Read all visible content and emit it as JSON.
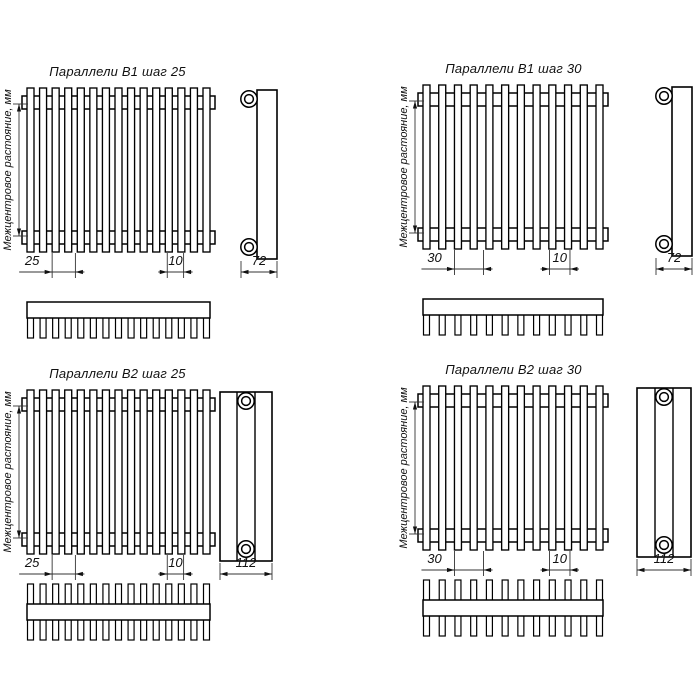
{
  "page": {
    "background": "#ffffff",
    "line_color": "#000000",
    "sheet_type": "technical drawing, radiator parallels"
  },
  "panels": [
    {
      "title": "Параллели В1 шаг 25",
      "variant": "В1",
      "step": "25",
      "tube_width": "10",
      "depth": "72",
      "tube_count": 15,
      "tube_rows": 1,
      "center_distance_label": "Межцентровое растояние, мм"
    },
    {
      "title": "Параллели В1 шаг 30",
      "variant": "В1",
      "step": "30",
      "tube_width": "10",
      "depth": "72",
      "tube_count": 12,
      "tube_rows": 1,
      "center_distance_label": "Межцентровое растояние, мм"
    },
    {
      "title": "Параллели В2 шаг 25",
      "variant": "В2",
      "step": "25",
      "tube_width": "10",
      "depth": "112",
      "tube_count": 15,
      "tube_rows": 2,
      "center_distance_label": "Межцентровое растояние, мм"
    },
    {
      "title": "Параллели В2 шаг 30",
      "variant": "В2",
      "step": "30",
      "tube_width": "10",
      "depth": "112",
      "tube_count": 12,
      "tube_rows": 2,
      "center_distance_label": "Межцентровое растояние, мм"
    }
  ]
}
